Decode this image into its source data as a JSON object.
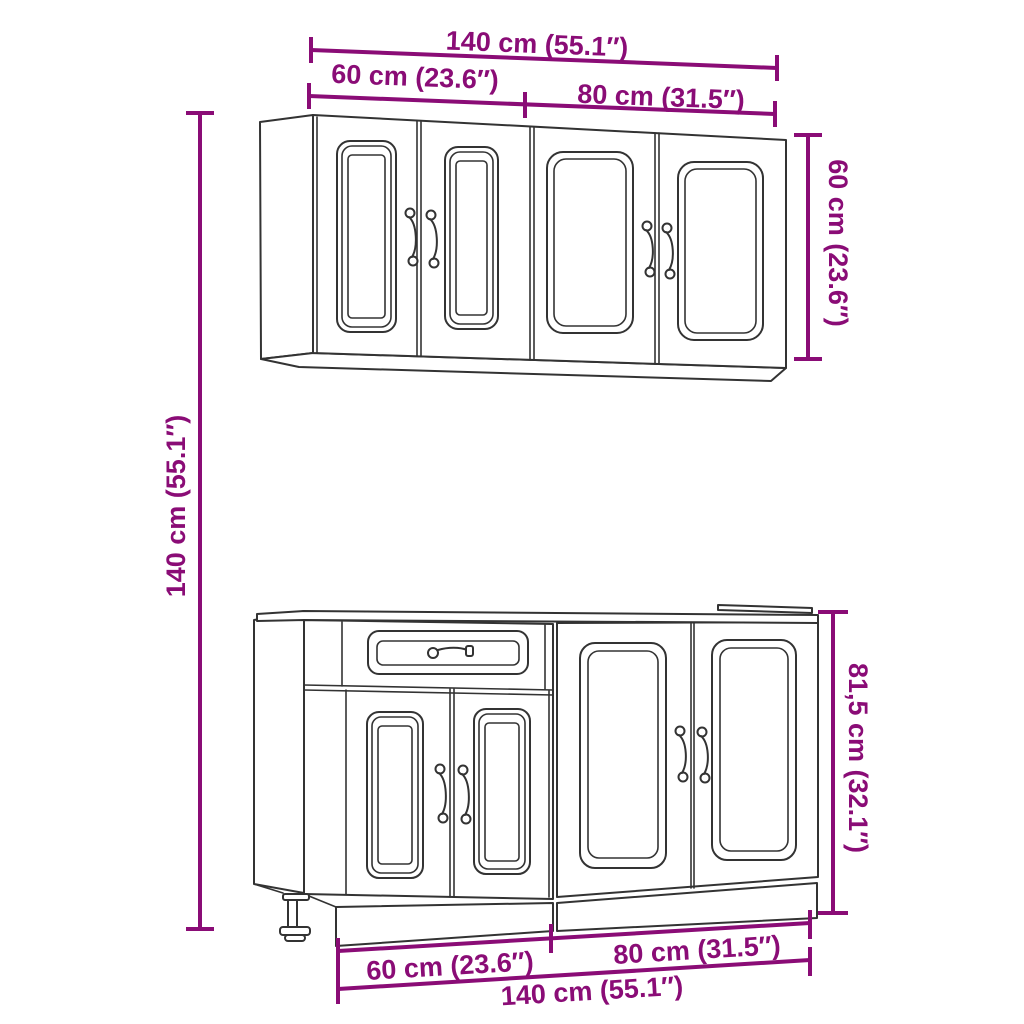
{
  "page": {
    "title": "Kitchen cabinet set — dimension drawing",
    "background": "#FFFFFF"
  },
  "colors": {
    "dimension_accent": "#8A0C76",
    "outline": "#333333"
  },
  "diagram": {
    "wall_cabinet": {
      "label": "wall cabinet",
      "doors": 4,
      "handles": 4
    },
    "base_cabinet": {
      "label": "base cabinet",
      "doors": 4,
      "drawers": 1,
      "adjustable_legs": 1
    }
  },
  "dims": {
    "top": {
      "total": "140 cm (55.1″)",
      "left": "60 cm (23.6″)",
      "right": "80 cm (31.5″)"
    },
    "left": {
      "total_height": "140 cm (55.1″)"
    },
    "right": {
      "wall_height": "60 cm (23.6″)",
      "base_height": "81,5 cm (32.1″)"
    },
    "bottom": {
      "left": "60 cm (23.6″)",
      "right": "80 cm (31.5″)",
      "total": "140 cm (55.1″)"
    }
  }
}
